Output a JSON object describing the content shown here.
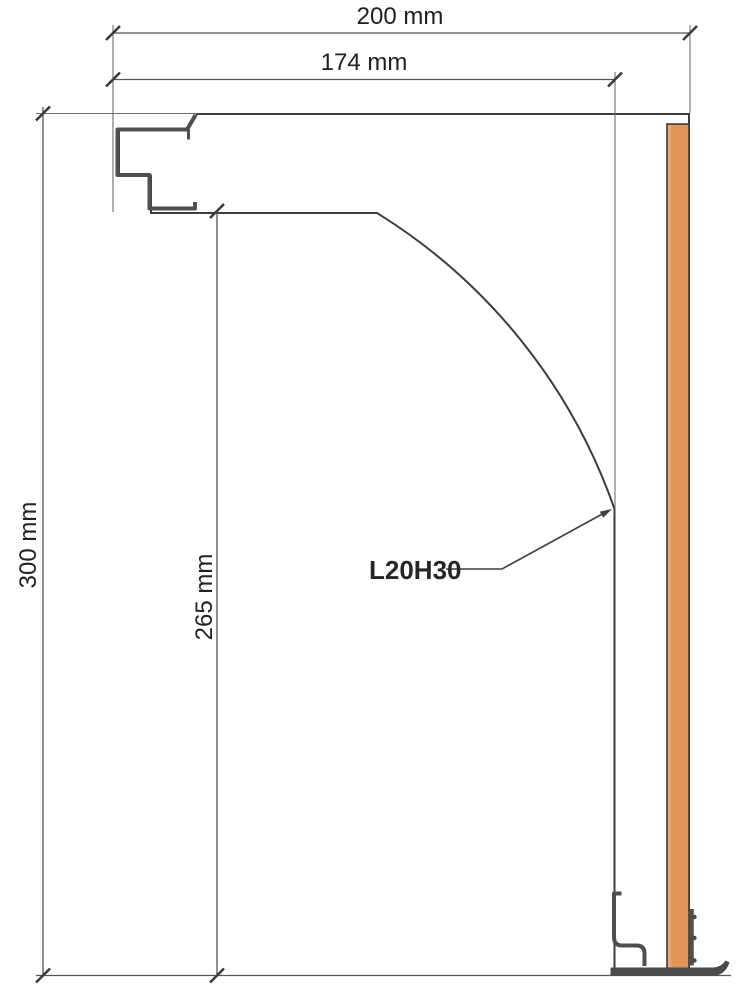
{
  "callout": {
    "profile_label": "L20H30"
  },
  "dimensions": {
    "overall_width": "200 mm",
    "inner_width": "174 mm",
    "overall_height": "300 mm",
    "inner_height": "265 mm"
  },
  "colors": {
    "material_base": "#e9eff5",
    "wood": "#e09659",
    "outline": "#3c3c3c",
    "metal": "#4f4f4f",
    "dim_line": "#555555",
    "text": "#202020"
  }
}
